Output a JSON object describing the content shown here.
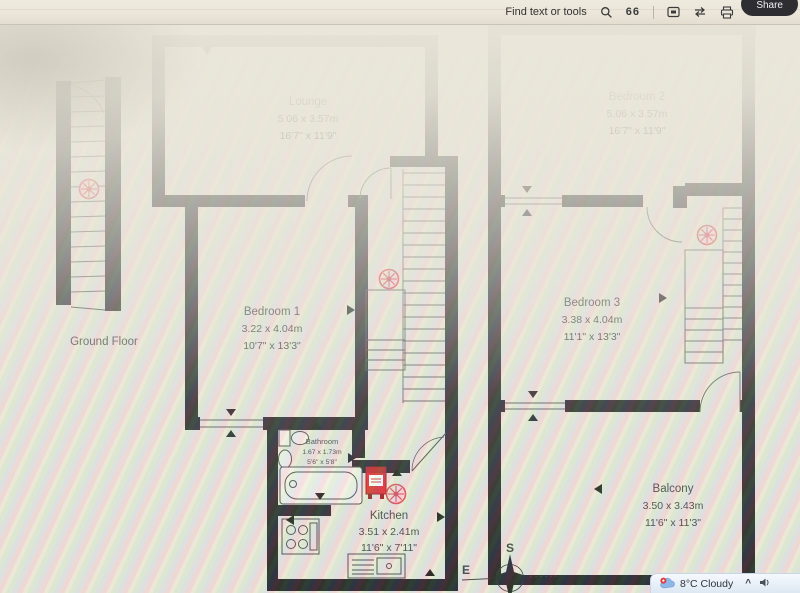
{
  "toolbar": {
    "find_label": "Find text or tools",
    "pages_glyph": "66",
    "share_label": "Share"
  },
  "taskbar": {
    "weather_label": "8°C Cloudy",
    "tray_chevron": "^"
  },
  "floorplan": {
    "ground_floor_label": "Ground Floor",
    "rooms": [
      {
        "name": "Lounge",
        "metric": "5.06 x 3.57m",
        "imperial": "16'7\" x 11'9\""
      },
      {
        "name": "Bedroom 2",
        "metric": "5.06 x 3.57m",
        "imperial": "16'7\" x 11'9\""
      },
      {
        "name": "Bedroom 1",
        "metric": "3.22 x 4.04m",
        "imperial": "10'7\" x 13'3\""
      },
      {
        "name": "Bedroom 3",
        "metric": "3.38 x 4.04m",
        "imperial": "11'1\" x 13'3\""
      },
      {
        "name": "Bathroom",
        "metric": "1.67 x 1.73m",
        "imperial": "5'6\" x 5'8\""
      },
      {
        "name": "Kitchen",
        "metric": "3.51 x 2.41m",
        "imperial": "11'6\" x 7'11\""
      },
      {
        "name": "Balcony",
        "metric": "3.50 x 3.43m",
        "imperial": "11'6\" x 11'3\""
      }
    ],
    "compass": {
      "south_label": "S",
      "east_label": "E"
    },
    "colors": {
      "wall": "#1c1c1e",
      "alarm_red": "#d9434a",
      "boiler_red": "#dd2424"
    }
  }
}
